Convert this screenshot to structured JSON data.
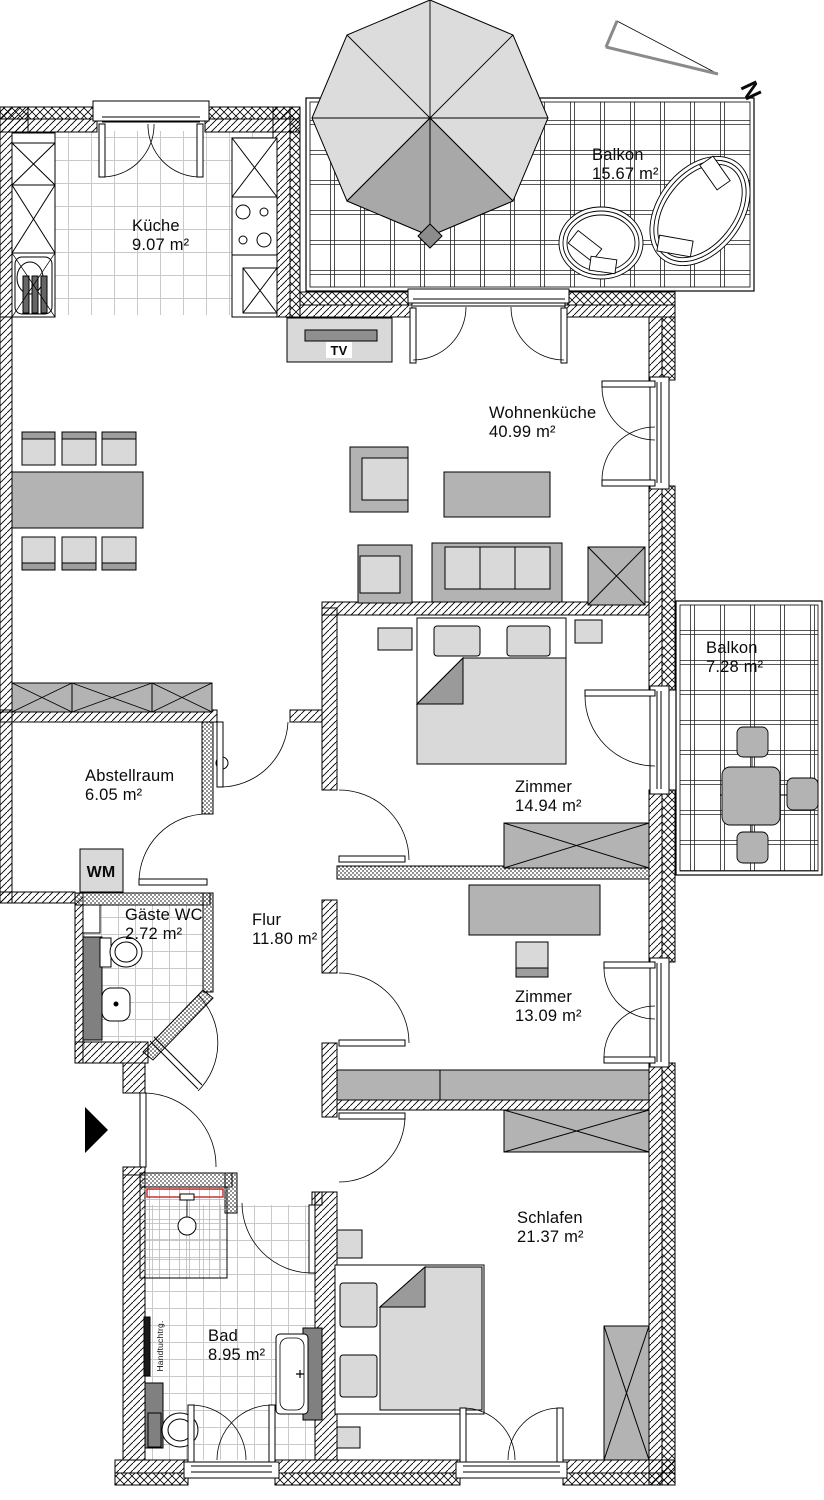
{
  "rooms": {
    "kueche": {
      "name": "Küche",
      "area": "9.07 m²"
    },
    "wohnkueche": {
      "name": "Wohnenküche",
      "area": "40.99 m²"
    },
    "balkon_gross": {
      "name": "Balkon",
      "area": "15.67 m²"
    },
    "balkon_klein": {
      "name": "Balkon",
      "area": "7.28 m²"
    },
    "abstellraum": {
      "name": "Abstellraum",
      "area": "6.05 m²"
    },
    "gaeste_wc": {
      "name": "Gäste WC",
      "area": "2.72 m²"
    },
    "flur": {
      "name": "Flur",
      "area": "11.80 m²"
    },
    "zimmer_1": {
      "name": "Zimmer",
      "area": "14.94 m²"
    },
    "zimmer_2": {
      "name": "Zimmer",
      "area": "13.09 m²"
    },
    "schlafen": {
      "name": "Schlafen",
      "area": "21.37 m²"
    },
    "bad": {
      "name": "Bad",
      "area": "8.95 m²"
    }
  },
  "annotations": {
    "tv": "TV",
    "wm": "WM",
    "towel_rail": "Handtuchtrg.",
    "compass_north": "N"
  },
  "colors": {
    "furniture_light": "#d9d9d9",
    "furniture_mid": "#b3b3b3",
    "furniture_dark": "#808080",
    "shower_accent": "#c83232",
    "line": "#000000"
  }
}
